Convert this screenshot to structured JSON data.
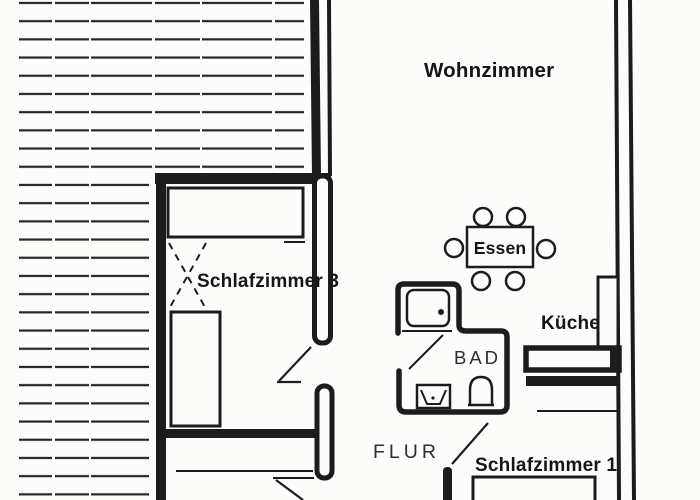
{
  "floorplan": {
    "rooms": {
      "wohnzimmer": {
        "label": "Wohnzimmer"
      },
      "schlafzimmer3": {
        "label": "Schlafzimmer 3"
      },
      "essen": {
        "label": "Essen"
      },
      "kueche": {
        "label": "Küche"
      },
      "bad": {
        "label": "BAD"
      },
      "flur": {
        "label": "FLUR"
      },
      "schlafzimmer1": {
        "label": "Schlafzimmer 1"
      }
    },
    "colors": {
      "ink": "#1c1c1c",
      "paper": "#fcfcfb"
    }
  }
}
